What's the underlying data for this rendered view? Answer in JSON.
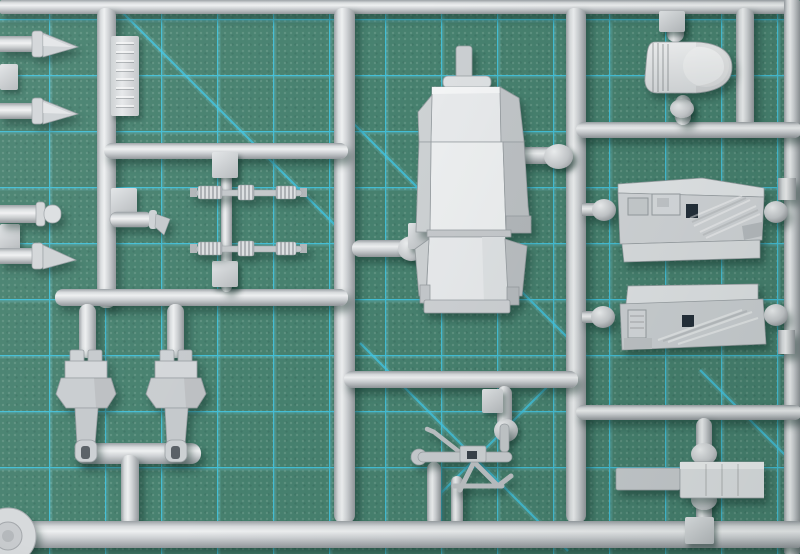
{
  "scene": {
    "type": "photograph",
    "subject": "Injection-molded model kit sprue on a cutting mat",
    "description": "Close-up photo of a light gray plastic model kit sprue (parts tree) holding cockpit parts - an ejection seat, instrument panel, side console, rounded cowl, seat frame legs, probes, ribbed rods and a control linkage - lying on a green self-healing cutting mat with a cyan grid and 45-degree guide lines.",
    "readable_text": ""
  },
  "palette": {
    "mat_green": "#47816F",
    "grid_cyan": "#41C6E3",
    "plastic_light": "#EDEFF0",
    "plastic_mid": "#C6C9CC",
    "plastic_dark": "#91969A",
    "recess_dark": "#242F3A",
    "cast_shadow": "rgba(15,45,38,0.45)"
  },
  "mat": {
    "grid_spacing_px": 56,
    "diagonal_guides": 5
  },
  "sprue": {
    "material": "light gray polystyrene",
    "runner_count": 12,
    "parts": {
      "label_tab": {
        "title": "Embossed label tab (lettering illegible)"
      },
      "pitot_probe_1": {
        "title": "Probe/pitot part"
      },
      "pitot_probe_2": {
        "title": "Probe/pitot part"
      },
      "pitot_probe_3": {
        "title": "Probe/pitot part"
      },
      "nose_cylinder": {
        "title": "Cylindrical part with domed cap"
      },
      "gun_barrel": {
        "title": "Barrel part with bent tip"
      },
      "actuator_rod_1": {
        "title": "Ribbed actuator rod"
      },
      "actuator_rod_2": {
        "title": "Ribbed actuator rod"
      },
      "ejection_seat": {
        "title": "Ejection seat"
      },
      "headrest_cowl": {
        "title": "Rounded cowl with ribbed edge"
      },
      "instrument_panel": {
        "title": "Instrument panel with raised detail"
      },
      "side_console": {
        "title": "Side console panel with diagonal ribbing"
      },
      "flat_rail": {
        "title": "Flat stepped rail part"
      },
      "seat_frame_left": {
        "title": "Seat/gear frame part"
      },
      "seat_frame_right": {
        "title": "Seat/gear frame part"
      },
      "control_linkage": {
        "title": "Control linkage assembly"
      },
      "wheel_disc": {
        "title": "Wheel disc (corner, partially visible)"
      },
      "gate_tabs": {
        "title": "Small square gate tabs"
      }
    }
  }
}
